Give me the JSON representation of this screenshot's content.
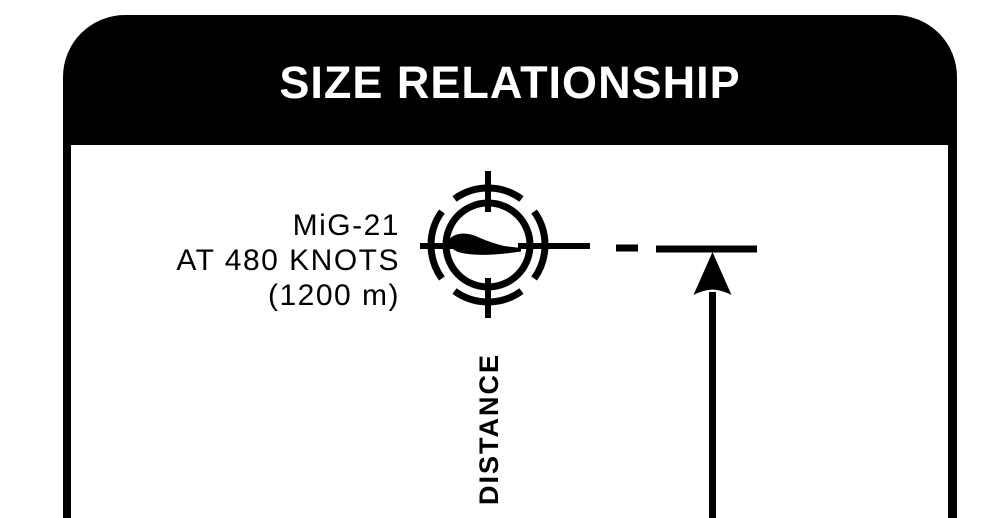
{
  "title_banner": {
    "title": "SIZE RELATIONSHIP",
    "fill_color": "#000000",
    "text_color": "#ffffff"
  },
  "target_label": {
    "line1": "MiG-21",
    "line2": "AT 480 KNOTS",
    "line3": "(1200 m)"
  },
  "axis_label": {
    "distance": "DISTANCE"
  },
  "icons": {
    "reticle": "gunsight-reticle-icon",
    "aircraft": "mig21-silhouette-icon",
    "arrow": "up-arrow-icon"
  },
  "colors": {
    "ink": "#000000",
    "paper": "#ffffff"
  }
}
